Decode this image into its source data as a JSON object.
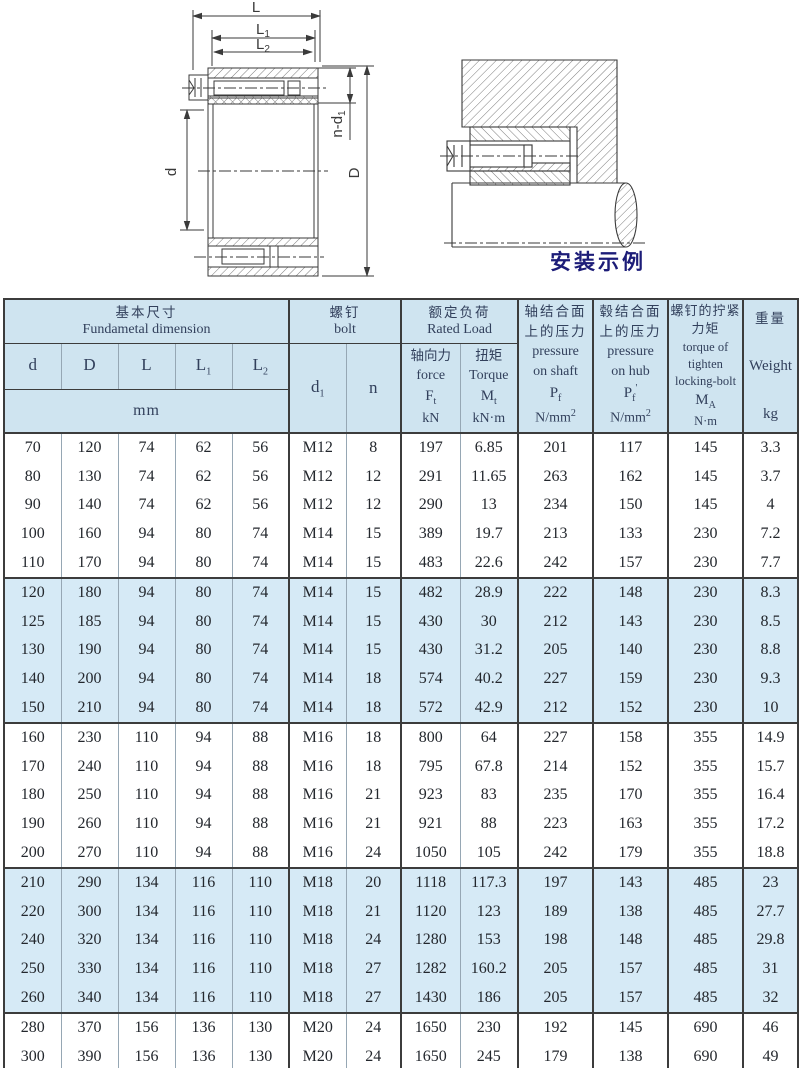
{
  "drawing_left": {
    "dim_L": "L",
    "dim_L1_base": "L",
    "dim_L1_sub": "1",
    "dim_L2_base": "L",
    "dim_L2_sub": "2",
    "dim_nd1_base": "n-d",
    "dim_nd1_sub": "1",
    "dim_d": "d",
    "dim_D": "D"
  },
  "drawing_right": {
    "caption": "安装示例"
  },
  "colors": {
    "header_bg": "#cfe4f0",
    "band_bg": "#d6eaf6",
    "caption": "#1c1c78",
    "heavy_border": "#3c3c3c"
  },
  "table": {
    "header": {
      "basic": {
        "cn": "基本尺寸",
        "en": "Fundametal dimension"
      },
      "dims": [
        {
          "base": "d",
          "sub": ""
        },
        {
          "base": "D",
          "sub": ""
        },
        {
          "base": "L",
          "sub": ""
        },
        {
          "base": "L",
          "sub": "1"
        },
        {
          "base": "L",
          "sub": "2"
        }
      ],
      "unit_mm": "mm",
      "bolt": {
        "cn": "螺钉",
        "en": "bolt",
        "d1_base": "d",
        "d1_sub": "1",
        "n": "n"
      },
      "rated": {
        "cn": "额定负荷",
        "en": "Rated Load",
        "force": {
          "cn": "轴向力",
          "en": "force",
          "sym_base": "F",
          "sym_sub": "t",
          "unit": "kN"
        },
        "torque": {
          "cn": "扭矩",
          "en": "Torque",
          "sym_base": "M",
          "sym_sub": "t",
          "unit": "kN·m"
        }
      },
      "pressure_shaft": {
        "cn1": "轴结合面",
        "cn2": "上的压力",
        "en1": "pressure",
        "en2": "on shaft",
        "sym_base": "P",
        "sym_sub": "f",
        "unit_base": "N/mm",
        "unit_sup": "2"
      },
      "pressure_hub": {
        "cn1": "毂结合面",
        "cn2": "上的压力",
        "en1": "pressure",
        "en2": "on hub",
        "sym_base": "P",
        "sym_sub": "f",
        "sym_prime": "'",
        "unit_base": "N/mm",
        "unit_sup": "2"
      },
      "tighten": {
        "cn1": "螺钉的拧紧",
        "cn2": "力矩",
        "en1": "torque of",
        "en2": "tighten",
        "en3": "locking-bolt",
        "sym_base": "M",
        "sym_sub": "A",
        "unit": "N·m"
      },
      "weight": {
        "cn": "重量",
        "en": "Weight",
        "unit": "kg"
      }
    },
    "groups": [
      {
        "shaded": false,
        "rows": [
          [
            "70",
            "120",
            "74",
            "62",
            "56",
            "M12",
            "8",
            "197",
            "6.85",
            "201",
            "117",
            "145",
            "3.3"
          ],
          [
            "80",
            "130",
            "74",
            "62",
            "56",
            "M12",
            "12",
            "291",
            "11.65",
            "263",
            "162",
            "145",
            "3.7"
          ],
          [
            "90",
            "140",
            "74",
            "62",
            "56",
            "M12",
            "12",
            "290",
            "13",
            "234",
            "150",
            "145",
            "4"
          ],
          [
            "100",
            "160",
            "94",
            "80",
            "74",
            "M14",
            "15",
            "389",
            "19.7",
            "213",
            "133",
            "230",
            "7.2"
          ],
          [
            "110",
            "170",
            "94",
            "80",
            "74",
            "M14",
            "15",
            "483",
            "22.6",
            "242",
            "157",
            "230",
            "7.7"
          ]
        ]
      },
      {
        "shaded": true,
        "rows": [
          [
            "120",
            "180",
            "94",
            "80",
            "74",
            "M14",
            "15",
            "482",
            "28.9",
            "222",
            "148",
            "230",
            "8.3"
          ],
          [
            "125",
            "185",
            "94",
            "80",
            "74",
            "M14",
            "15",
            "430",
            "30",
            "212",
            "143",
            "230",
            "8.5"
          ],
          [
            "130",
            "190",
            "94",
            "80",
            "74",
            "M14",
            "15",
            "430",
            "31.2",
            "205",
            "140",
            "230",
            "8.8"
          ],
          [
            "140",
            "200",
            "94",
            "80",
            "74",
            "M14",
            "18",
            "574",
            "40.2",
            "227",
            "159",
            "230",
            "9.3"
          ],
          [
            "150",
            "210",
            "94",
            "80",
            "74",
            "M14",
            "18",
            "572",
            "42.9",
            "212",
            "152",
            "230",
            "10"
          ]
        ]
      },
      {
        "shaded": false,
        "rows": [
          [
            "160",
            "230",
            "110",
            "94",
            "88",
            "M16",
            "18",
            "800",
            "64",
            "227",
            "158",
            "355",
            "14.9"
          ],
          [
            "170",
            "240",
            "110",
            "94",
            "88",
            "M16",
            "18",
            "795",
            "67.8",
            "214",
            "152",
            "355",
            "15.7"
          ],
          [
            "180",
            "250",
            "110",
            "94",
            "88",
            "M16",
            "21",
            "923",
            "83",
            "235",
            "170",
            "355",
            "16.4"
          ],
          [
            "190",
            "260",
            "110",
            "94",
            "88",
            "M16",
            "21",
            "921",
            "88",
            "223",
            "163",
            "355",
            "17.2"
          ],
          [
            "200",
            "270",
            "110",
            "94",
            "88",
            "M16",
            "24",
            "1050",
            "105",
            "242",
            "179",
            "355",
            "18.8"
          ]
        ]
      },
      {
        "shaded": true,
        "rows": [
          [
            "210",
            "290",
            "134",
            "116",
            "110",
            "M18",
            "20",
            "1118",
            "117.3",
            "197",
            "143",
            "485",
            "23"
          ],
          [
            "220",
            "300",
            "134",
            "116",
            "110",
            "M18",
            "21",
            "1120",
            "123",
            "189",
            "138",
            "485",
            "27.7"
          ],
          [
            "240",
            "320",
            "134",
            "116",
            "110",
            "M18",
            "24",
            "1280",
            "153",
            "198",
            "148",
            "485",
            "29.8"
          ],
          [
            "250",
            "330",
            "134",
            "116",
            "110",
            "M18",
            "27",
            "1282",
            "160.2",
            "205",
            "157",
            "485",
            "31"
          ],
          [
            "260",
            "340",
            "134",
            "116",
            "110",
            "M18",
            "27",
            "1430",
            "186",
            "205",
            "157",
            "485",
            "32"
          ]
        ]
      },
      {
        "shaded": false,
        "rows": [
          [
            "280",
            "370",
            "156",
            "136",
            "130",
            "M20",
            "24",
            "1650",
            "230",
            "192",
            "145",
            "690",
            "46"
          ],
          [
            "300",
            "390",
            "156",
            "136",
            "130",
            "M20",
            "24",
            "1650",
            "245",
            "179",
            "138",
            "690",
            "49"
          ]
        ]
      }
    ]
  }
}
